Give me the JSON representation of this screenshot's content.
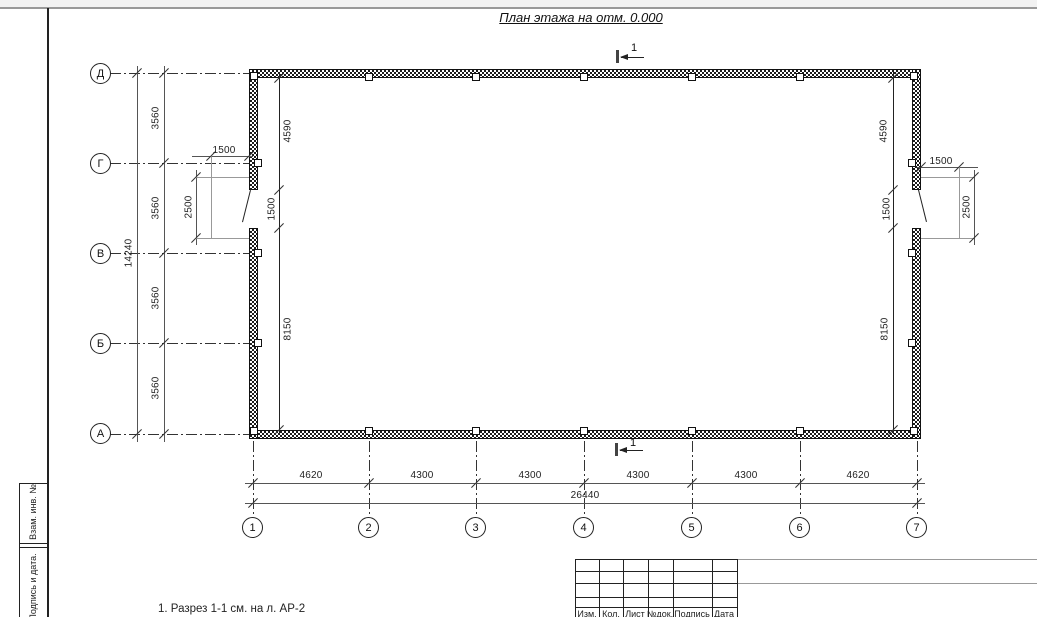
{
  "title": "План этажа на отм. 0.000",
  "section_mark": {
    "label": "1"
  },
  "axes": {
    "rows": [
      "Д",
      "Г",
      "В",
      "Б",
      "А"
    ],
    "cols": [
      "1",
      "2",
      "3",
      "4",
      "5",
      "6",
      "7"
    ]
  },
  "dims": {
    "bottom_segments": [
      "4620",
      "4300",
      "4300",
      "4300",
      "4300",
      "4620"
    ],
    "bottom_total": "26440",
    "left_segments": [
      "3560",
      "3560",
      "3560",
      "3560"
    ],
    "left_total": "14240",
    "interior_left": [
      "4590",
      "1500",
      "8150"
    ],
    "interior_right": [
      "4590",
      "1500",
      "8150"
    ],
    "door_left": {
      "width": "1500",
      "swing": "2500"
    },
    "door_right": {
      "width": "1500",
      "swing": "2500"
    }
  },
  "note": "1. Разрез 1-1 см. на л. АР-2",
  "stamp_left": {
    "cells": [
      "Взам. инв. №",
      "Подпись и дата."
    ]
  },
  "title_block": {
    "headers": [
      "Изм.",
      "Кол.",
      "Лист",
      "№док.",
      "Подпись",
      "Дата"
    ]
  },
  "colors": {
    "paper": "#ffffff",
    "line": "#555555",
    "ink": "#111111"
  }
}
